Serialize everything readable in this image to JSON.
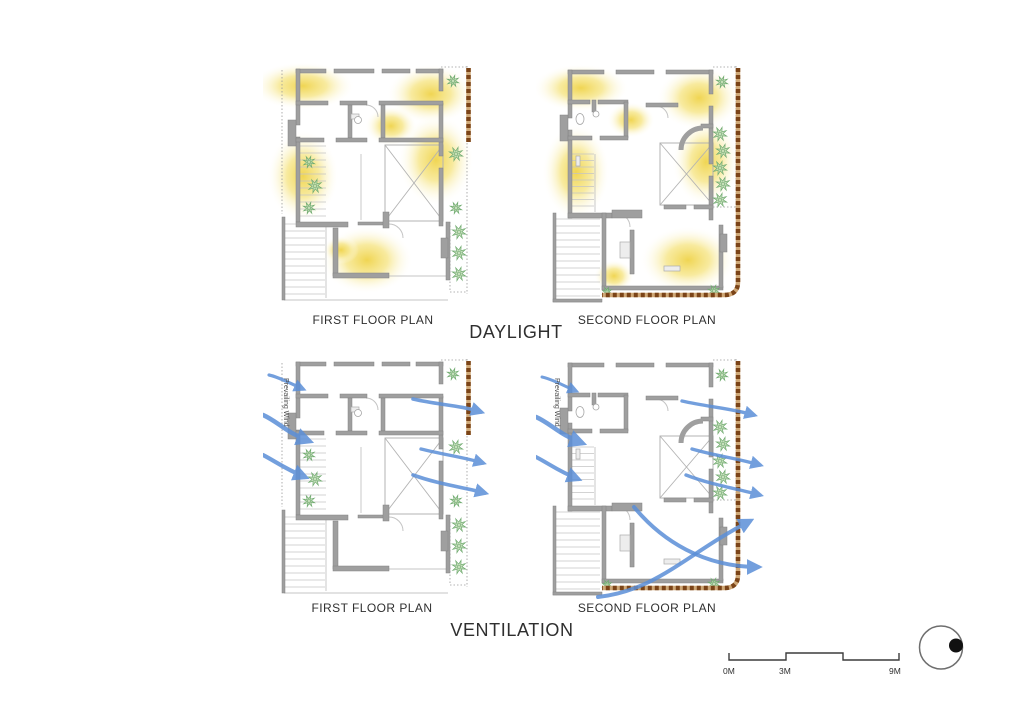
{
  "daylight": {
    "title": "DAYLIGHT",
    "first_plan_label": "FIRST FLOOR PLAN",
    "second_plan_label": "SECOND FLOOR PLAN"
  },
  "ventilation": {
    "title": "VENTILATION",
    "first_plan_label": "FIRST FLOOR PLAN",
    "second_plan_label": "SECOND FLOOR PLAN",
    "wind_label": "Prevailing Wind"
  },
  "scale_bar": {
    "tick_0": "0M",
    "tick_3": "3M",
    "tick_9": "9M"
  },
  "colors": {
    "wall": "#9f9f9f",
    "wall_edge": "#818181",
    "daylight_core": "#efd34a",
    "daylight_mid": "#f6e586",
    "wind_blue": "#5b8fd8",
    "plant_fill": "#bdd9b2",
    "plant_stroke": "#6faa6f",
    "boundary_brown": "#7b4418",
    "boundary_tan": "#cfa877",
    "line_light": "#c4c4c4",
    "line_dotted": "#9a9a9a",
    "text": "#2f2f2f",
    "compass_ring": "#6e6e6e",
    "compass_dot": "#111111",
    "scale_line": "#3c3c3c"
  }
}
